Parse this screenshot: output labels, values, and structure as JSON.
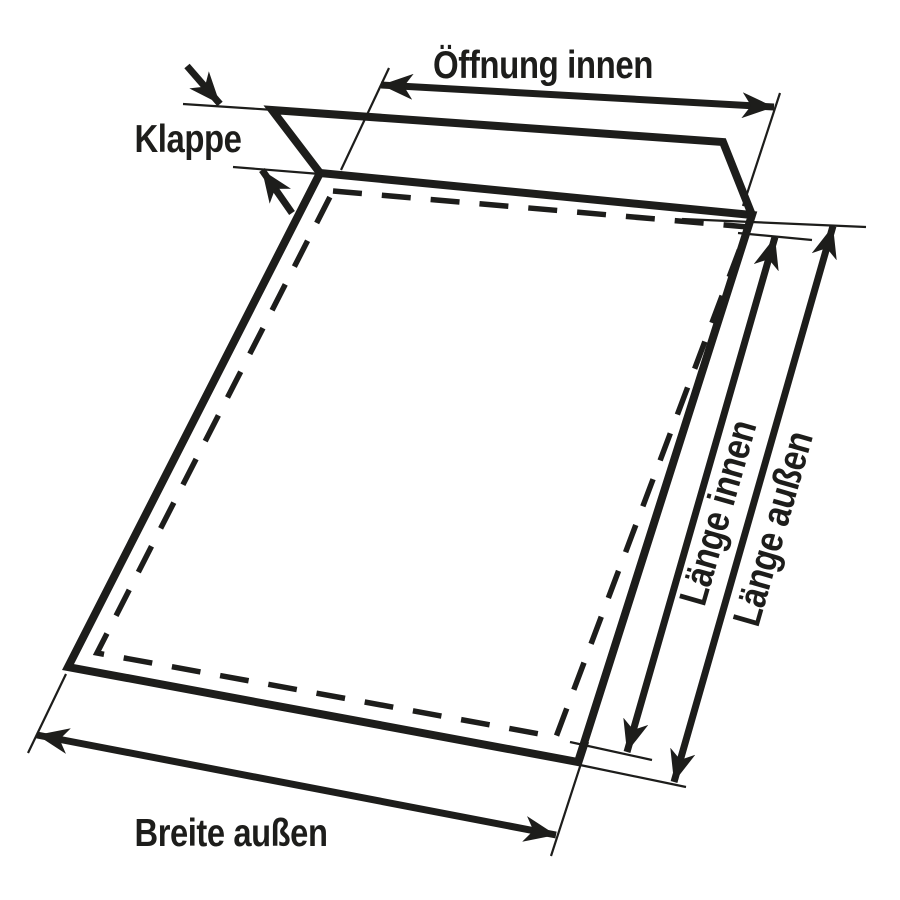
{
  "diagram": {
    "dimensions": [
      {
        "id": "oeffnung-innen",
        "label": "Öffnung innen"
      },
      {
        "id": "klappe",
        "label": "Klappe"
      },
      {
        "id": "laenge-innen",
        "label": "Länge innen"
      },
      {
        "id": "laenge-aussen",
        "label": "Länge außen"
      },
      {
        "id": "breite-aussen",
        "label": "Breite außen"
      }
    ]
  },
  "colors": {
    "ink": "#1d1d1b",
    "background": "#ffffff"
  }
}
